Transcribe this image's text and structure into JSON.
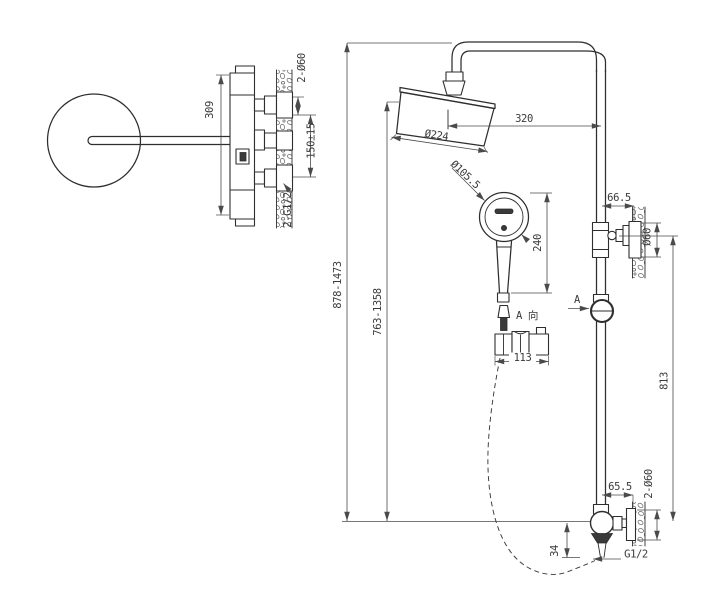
{
  "colors": {
    "background": "#ffffff",
    "line": "#2e2e2e",
    "dimension": "#4a4a4a"
  },
  "side_view": {
    "dim_body_height": "309",
    "dim_mount_holes": "2-Ø60",
    "dim_inlet_spacing": "150±15",
    "dim_inlet_thread": "2-G1/2"
  },
  "front_view": {
    "dim_overall_height": "878-1473",
    "dim_riser_height": "763-1358",
    "dim_arm_reach": "320",
    "dim_head_diameter": "Ø224",
    "dim_handshower_diameter": "Ø105.5",
    "dim_handshower_length": "240",
    "dim_upper_bracket_offset": "66.5",
    "dim_upper_flange_diameter": "Ø60",
    "dim_bracket_to_valve": "813",
    "dim_lower_offset": "65.5",
    "dim_lower_flange_holes": "2-Ø60",
    "dim_outlet_drop": "34",
    "label_outlet_thread": "G1/2",
    "section_arrow_label": "A",
    "view_label": "A 向",
    "dim_slider_width": "113"
  }
}
